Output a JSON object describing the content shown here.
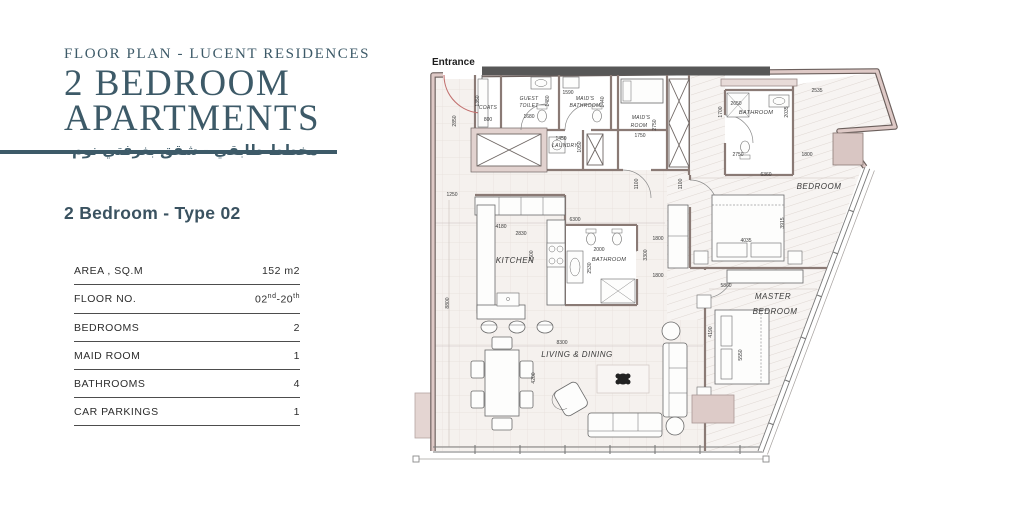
{
  "header": {
    "eyebrow": "FLOOR PLAN - LUCENT RESIDENCES",
    "title_line1": "2 BEDROOM",
    "title_line2": "APARTMENTS",
    "subtitle_ar": "مخطط طابقي - شقق بغرفتي نوم"
  },
  "unit": {
    "heading": "2 Bedroom - Type 02"
  },
  "specs": {
    "area_label": "AREA , SQ.M",
    "area_value": "152 m2",
    "floor_label": "FLOOR NO.",
    "floor_value": {
      "p1": "02",
      "s1": "nd",
      "p2": "-20",
      "s2": "th"
    },
    "bedrooms_label": "BEDROOMS",
    "bedrooms_value": "2",
    "maid_label": "MAID ROOM",
    "maid_value": "1",
    "bath_label": "BATHROOMS",
    "bath_value": "4",
    "parking_label": "CAR PARKINGS",
    "parking_value": "1"
  },
  "floorplan": {
    "entrance_label": "Entrance",
    "rooms": [
      "COATS",
      "GUEST",
      "TOILET",
      "MAID'S",
      "BATHROOM",
      "LAUNDRY",
      "MAID'S",
      "ROOM",
      "BATHROOM",
      "BEDROOM",
      "KITCHEN",
      "BATHROOM",
      "LIVING & DINING",
      "MASTER",
      "BEDROOM"
    ],
    "dims": [
      "2850",
      "1250",
      "8800",
      "1350",
      "800",
      "1680",
      "1480",
      "1590",
      "1440",
      "1450",
      "1050",
      "1750",
      "2750",
      "2650",
      "1700",
      "2535",
      "2035",
      "2750",
      "1800",
      "6360",
      "1100",
      "1100",
      "6300",
      "4180",
      "2830",
      "1500",
      "2000",
      "2530",
      "1800",
      "3300",
      "1800",
      "4035",
      "3915",
      "5860",
      "8300",
      "4200",
      "4190",
      "5550"
    ],
    "colors": {
      "accent_teal": "#3d5a68",
      "wall_pink": "#dec9c6",
      "core_gray": "#575757",
      "door_red": "#c2706e"
    }
  }
}
